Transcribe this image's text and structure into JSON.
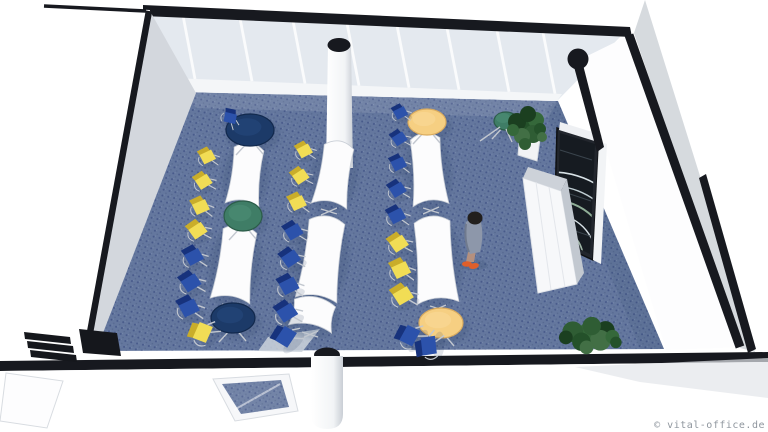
{
  "watermark": {
    "text": "© vital-office.de"
  },
  "palette": {
    "edge_black": "#17191f",
    "wall_white": "#ffffff",
    "wall_gray": "#d6dade",
    "glass": "#e4e9ef",
    "carpet_base": "#64779e",
    "carpet_dot": "#47598a",
    "table_white": "#fcfcfd",
    "chair_yellow": "#f1dd55",
    "chair_yellow_dark": "#c9ad2a",
    "chair_blue": "#2c52ab",
    "chair_blue_dark": "#17327c",
    "round_navy": "#1c3a68",
    "round_green": "#3f7d66",
    "round_tan": "#f6cf82",
    "plant_greens": [
      "#24512a",
      "#35683a",
      "#1b3f20",
      "#2f5d34",
      "#426f45"
    ],
    "chrome": "#c2c7cf",
    "person_suit": "#8d97aa",
    "person_hair": "#221f1d",
    "person_skin": "#b5907e",
    "person_shoes": "#df5f2b",
    "screen_dark": "#161b21"
  },
  "scene": {
    "description": "3D cutaway rendering of a seminar room: three rows of white wave tables with yellow and blue chairs, round end tables, blue dotted carpet, window wall, presentation screen on right wall, two plants, one standing person",
    "rows": [
      {
        "segments": [
          {
            "x1": 249,
            "y1": 149,
            "x2": 242,
            "y2": 205,
            "w1": 15,
            "w2": 17
          },
          {
            "x1": 240,
            "y1": 231,
            "x2": 230,
            "y2": 301,
            "w1": 17,
            "w2": 20
          }
        ]
      },
      {
        "segments": [
          {
            "x1": 339,
            "y1": 147,
            "x2": 329,
            "y2": 206,
            "w1": 15,
            "w2": 18
          },
          {
            "x1": 327,
            "y1": 222,
            "x2": 316,
            "y2": 300,
            "w1": 18,
            "w2": 21
          },
          {
            "x1": 315,
            "y1": 303,
            "x2": 310,
            "y2": 329,
            "w1": 21,
            "w2": 22
          }
        ]
      },
      {
        "segments": [
          {
            "x1": 425,
            "y1": 139,
            "x2": 431,
            "y2": 205,
            "w1": 15,
            "w2": 18
          },
          {
            "x1": 432,
            "y1": 222,
            "x2": 438,
            "y2": 303,
            "w1": 18,
            "w2": 21
          }
        ]
      }
    ],
    "round_tables": [
      {
        "cx": 250,
        "cy": 130,
        "rx": 24,
        "ry": 16,
        "color": "navy"
      },
      {
        "cx": 243,
        "cy": 216,
        "rx": 19,
        "ry": 15,
        "color": "green"
      },
      {
        "cx": 233,
        "cy": 318,
        "rx": 22,
        "ry": 15,
        "color": "navy"
      },
      {
        "cx": 427,
        "cy": 122,
        "rx": 19,
        "ry": 13,
        "color": "tan"
      },
      {
        "cx": 441,
        "cy": 323,
        "rx": 22,
        "ry": 15,
        "color": "tan"
      },
      {
        "cx": 506,
        "cy": 121,
        "rx": 12,
        "ry": 9,
        "color": "green"
      }
    ],
    "chairs": [
      {
        "x": 229,
        "y": 117,
        "c": "blue",
        "r": 25
      },
      {
        "x": 206,
        "y": 157,
        "c": "yellow",
        "r": -14
      },
      {
        "x": 202,
        "y": 182,
        "c": "yellow",
        "r": -20
      },
      {
        "x": 199,
        "y": 207,
        "c": "yellow",
        "r": -12
      },
      {
        "x": 196,
        "y": 231,
        "c": "yellow",
        "r": -22
      },
      {
        "x": 192,
        "y": 257,
        "c": "blue",
        "r": -16
      },
      {
        "x": 189,
        "y": 283,
        "c": "blue",
        "r": -20
      },
      {
        "x": 187,
        "y": 308,
        "c": "blue",
        "r": -14
      },
      {
        "x": 201,
        "y": 334,
        "c": "yellow",
        "r": -55
      },
      {
        "x": 303,
        "y": 151,
        "c": "yellow",
        "r": -16
      },
      {
        "x": 299,
        "y": 177,
        "c": "yellow",
        "r": -22
      },
      {
        "x": 296,
        "y": 203,
        "c": "yellow",
        "r": -13
      },
      {
        "x": 292,
        "y": 232,
        "c": "blue",
        "r": -18
      },
      {
        "x": 289,
        "y": 259,
        "c": "blue",
        "r": -22
      },
      {
        "x": 287,
        "y": 286,
        "c": "blue",
        "r": -15
      },
      {
        "x": 285,
        "y": 313,
        "c": "blue",
        "r": -20
      },
      {
        "x": 284,
        "y": 338,
        "c": "blue",
        "r": -45
      },
      {
        "x": 399,
        "y": 113,
        "c": "blue",
        "r": -15
      },
      {
        "x": 398,
        "y": 139,
        "c": "blue",
        "r": -21
      },
      {
        "x": 397,
        "y": 164,
        "c": "blue",
        "r": -13
      },
      {
        "x": 396,
        "y": 190,
        "c": "blue",
        "r": -19
      },
      {
        "x": 395,
        "y": 216,
        "c": "blue",
        "r": -15
      },
      {
        "x": 397,
        "y": 244,
        "c": "yellow",
        "r": -21
      },
      {
        "x": 399,
        "y": 270,
        "c": "yellow",
        "r": -13
      },
      {
        "x": 401,
        "y": 296,
        "c": "yellow",
        "r": -19
      },
      {
        "x": 408,
        "y": 337,
        "c": "blue",
        "r": -50
      },
      {
        "x": 428,
        "y": 348,
        "c": "blue",
        "r": -85
      }
    ],
    "plants": [
      {
        "cx": 527,
        "cy": 128,
        "s": 1.0,
        "flat": false
      },
      {
        "cx": 590,
        "cy": 336,
        "s": 1.15,
        "flat": true
      }
    ],
    "person": {
      "x": 474,
      "y": 238
    },
    "columns": [
      {
        "type": "center",
        "x": 339,
        "y": 45
      },
      {
        "type": "front",
        "x": 327,
        "y": 355
      },
      {
        "type": "corner",
        "x": 578,
        "y": 59
      }
    ],
    "windows": {
      "mullions": [
        183,
        240,
        293,
        347,
        397,
        447,
        497,
        543
      ]
    }
  }
}
